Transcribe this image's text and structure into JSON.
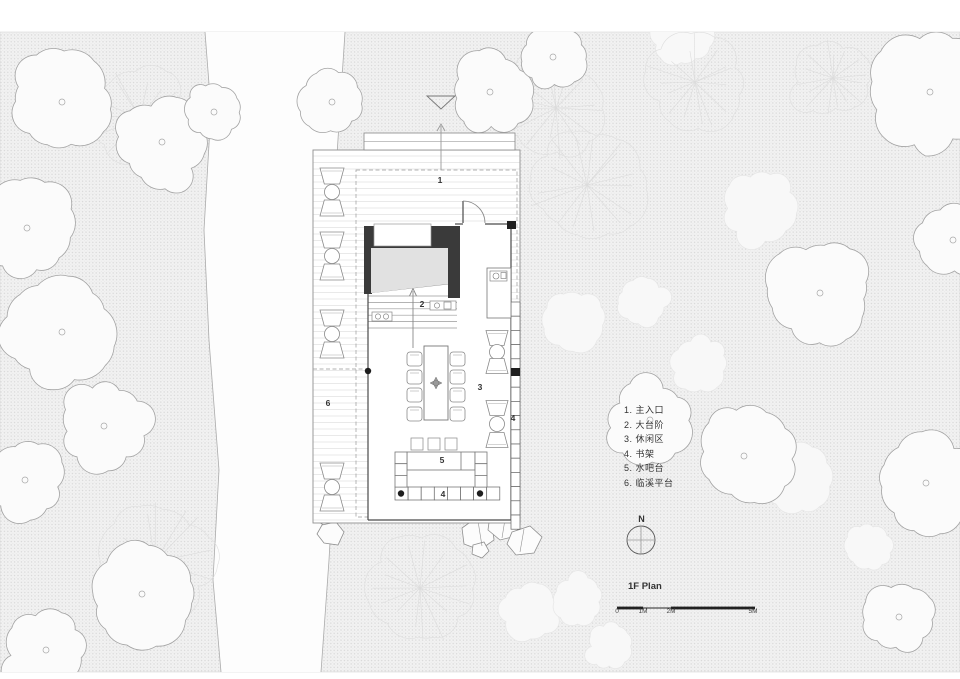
{
  "title": "1F Plan",
  "north_label": "N",
  "legend": {
    "items": [
      "1. 主入口",
      "2. 大台阶",
      "3. 休闲区",
      "4. 书架",
      "5. 水吧台",
      "6. 临溪平台"
    ]
  },
  "plan_numbers": [
    {
      "n": "1",
      "x": 440,
      "y": 183
    },
    {
      "n": "2",
      "x": 422,
      "y": 307
    },
    {
      "n": "3",
      "x": 480,
      "y": 390
    },
    {
      "n": "4",
      "x": 513,
      "y": 421
    },
    {
      "n": "5",
      "x": 442,
      "y": 463
    },
    {
      "n": "4",
      "x": 443,
      "y": 497
    },
    {
      "n": "6",
      "x": 328,
      "y": 406
    }
  ],
  "scalebar": {
    "ticks": [
      "0",
      "1M",
      "2M",
      "5M"
    ],
    "offsets": [
      0,
      26,
      54,
      136
    ]
  },
  "colors": {
    "wall_dark": "#3a3a3a",
    "room_fill": "#e1e1e1",
    "ground_dot": "#d7d7d7",
    "ground_bg": "#f2f2f2",
    "line_dark": "#4a4a4a",
    "line_mid": "#8f8f8f",
    "line_light": "#d4d4d4",
    "text": "#333333"
  },
  "site": {
    "trees": [
      {
        "type": "ghost",
        "x": 760,
        "y": 206,
        "r": 40
      },
      {
        "type": "ghost",
        "x": 800,
        "y": 481,
        "r": 38
      },
      {
        "type": "ghost",
        "x": 575,
        "y": 322,
        "r": 36
      },
      {
        "type": "ghost",
        "x": 640,
        "y": 302,
        "r": 26
      },
      {
        "type": "ghost",
        "x": 530,
        "y": 613,
        "r": 32
      },
      {
        "type": "ghost",
        "x": 578,
        "y": 600,
        "r": 26
      },
      {
        "type": "ghost",
        "x": 700,
        "y": 366,
        "r": 30
      },
      {
        "type": "ghost",
        "x": 868,
        "y": 548,
        "r": 24
      },
      {
        "type": "ghost",
        "x": 610,
        "y": 645,
        "r": 24
      },
      {
        "type": "ghost",
        "x": 680,
        "y": 38,
        "r": 32
      },
      {
        "type": "fan",
        "x": 155,
        "y": 562,
        "r": 64
      },
      {
        "type": "fan",
        "x": 420,
        "y": 588,
        "r": 60
      },
      {
        "type": "fan",
        "x": 587,
        "y": 185,
        "r": 62
      },
      {
        "type": "fan",
        "x": 695,
        "y": 82,
        "r": 52
      },
      {
        "type": "fan",
        "x": 556,
        "y": 108,
        "r": 52
      },
      {
        "type": "fan",
        "x": 833,
        "y": 78,
        "r": 40
      },
      {
        "type": "fan",
        "x": 140,
        "y": 118,
        "r": 55
      },
      {
        "type": "blob",
        "x": 62,
        "y": 102,
        "r": 56
      },
      {
        "type": "blob",
        "x": 162,
        "y": 142,
        "r": 48
      },
      {
        "type": "blob",
        "x": 27,
        "y": 228,
        "r": 52
      },
      {
        "type": "blob",
        "x": 62,
        "y": 332,
        "r": 62
      },
      {
        "type": "blob",
        "x": 104,
        "y": 426,
        "r": 46
      },
      {
        "type": "blob",
        "x": 25,
        "y": 480,
        "r": 42
      },
      {
        "type": "blob",
        "x": 142,
        "y": 594,
        "r": 58
      },
      {
        "type": "blob",
        "x": 46,
        "y": 650,
        "r": 44
      },
      {
        "type": "blob",
        "x": 332,
        "y": 102,
        "r": 36
      },
      {
        "type": "blob",
        "x": 490,
        "y": 92,
        "r": 44
      },
      {
        "type": "blob",
        "x": 553,
        "y": 57,
        "r": 36
      },
      {
        "type": "blob",
        "x": 930,
        "y": 92,
        "r": 68
      },
      {
        "type": "blob",
        "x": 953,
        "y": 240,
        "r": 40
      },
      {
        "type": "blob",
        "x": 820,
        "y": 293,
        "r": 58
      },
      {
        "type": "blob",
        "x": 650,
        "y": 420,
        "r": 44
      },
      {
        "type": "blob",
        "x": 744,
        "y": 456,
        "r": 52
      },
      {
        "type": "blob",
        "x": 926,
        "y": 483,
        "r": 57
      },
      {
        "type": "blob",
        "x": 899,
        "y": 617,
        "r": 40
      },
      {
        "type": "blob",
        "x": 214,
        "y": 112,
        "r": 30
      }
    ]
  }
}
